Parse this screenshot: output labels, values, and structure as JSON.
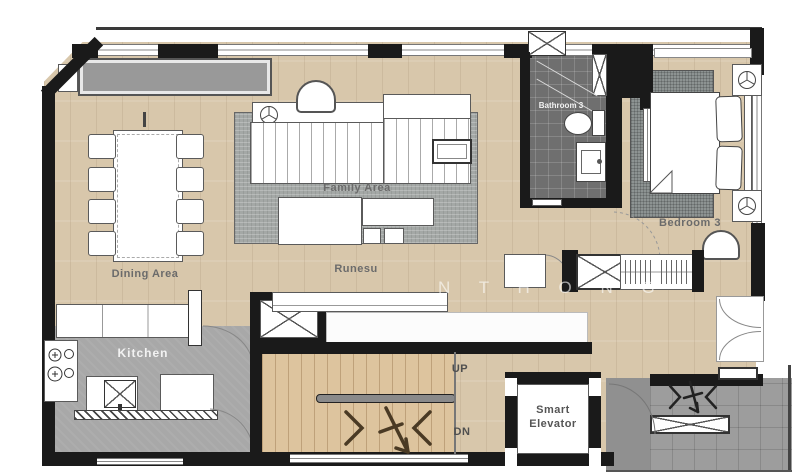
{
  "plan": {
    "watermark": "N T H O N G",
    "labels": {
      "dining": "Dining Area",
      "family": "Family Area",
      "runesu": "Runesu",
      "kitchen": "Kitchen",
      "bathroom": "Bathroom 3",
      "bedroom": "Bedroom 3",
      "up": "UP",
      "down": "DN",
      "elevator_line1": "Smart",
      "elevator_line2": "Elevator"
    },
    "colors": {
      "wall": "#1a1a1a",
      "wood_floor": "#d8c7ab",
      "stair_wood": "#ddc49e",
      "kitchen_tile": "#a8a8a8",
      "bathroom_tile": "#6f6f6f",
      "exterior_concrete": "#9d9d9d",
      "family_rug": "#a4a8a6",
      "bedroom_rug": "#8d9392",
      "label_text": "#6b6b6b"
    }
  }
}
